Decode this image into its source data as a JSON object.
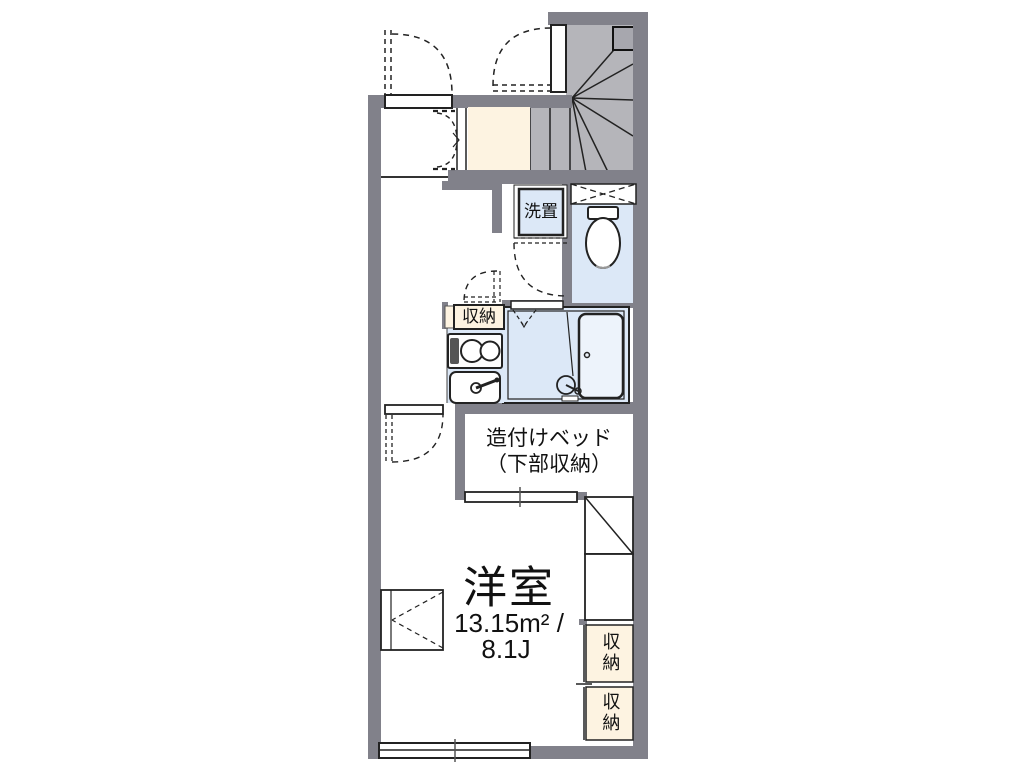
{
  "floor_plan": {
    "type": "japanese-apartment-floor-plan",
    "rooms": {
      "main_room": {
        "name": "洋室",
        "area_m2": "13.15m² /",
        "area_jou": "8.1J"
      },
      "built_in_bed": {
        "line1": "造付けベッド",
        "line2": "（下部収納）"
      },
      "washer_space": {
        "label": "洗置"
      },
      "kitchen_storage": {
        "label": "収納"
      },
      "storage_upper": {
        "label": "収納"
      },
      "storage_lower": {
        "label": "収納"
      }
    },
    "fixtures": [
      "winder-staircase",
      "entrance-genkan",
      "toilet",
      "bathtub",
      "two-burner-stove",
      "kitchen-sink",
      "washing-machine-space",
      "refrigerator-space",
      "built-in-bed",
      "sliding-windows"
    ],
    "colors": {
      "wall": "#81818a",
      "stair_fill": "#b5b5ba",
      "storage_cream": "#fdf3e1",
      "wet_area_blue": "#dce8f7",
      "line": "#1d1d1f",
      "background": "#ffffff"
    }
  }
}
